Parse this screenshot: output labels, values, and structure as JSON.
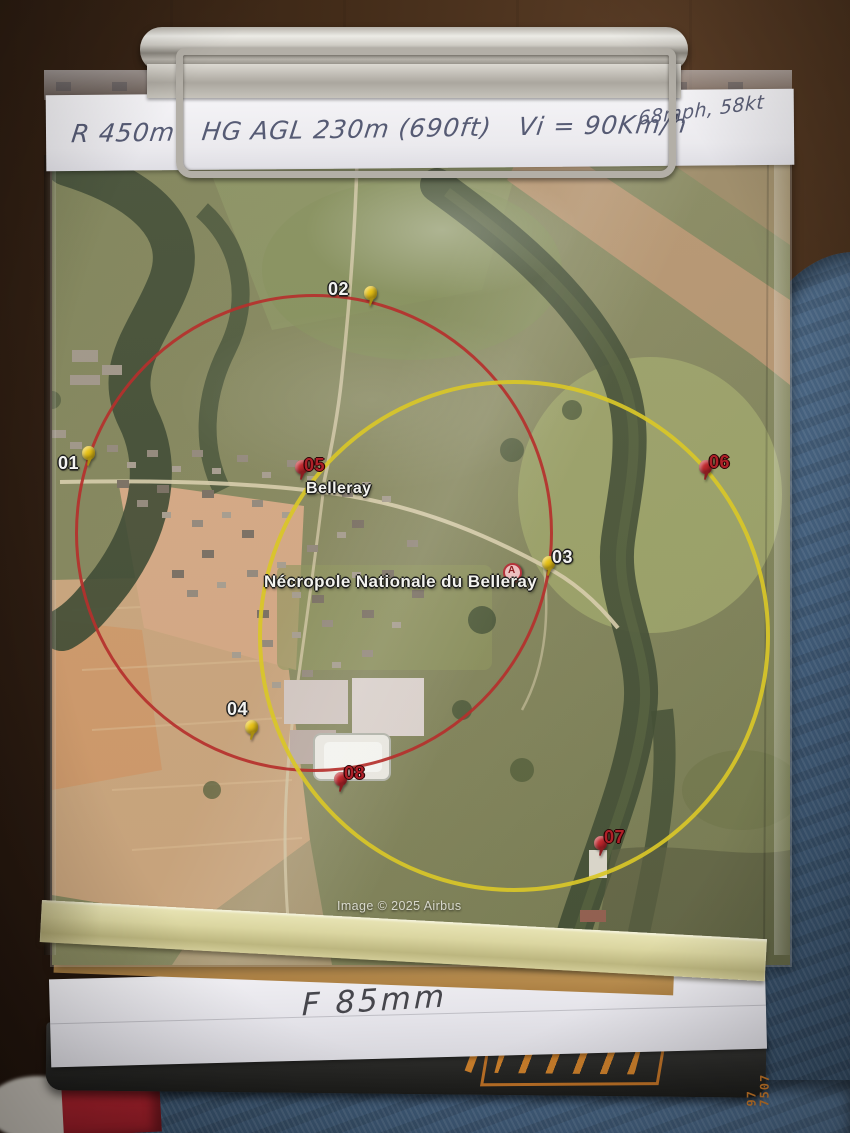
{
  "photo": {
    "handwriting": {
      "top_line": "R 450m   HG AGL 230m (690ft)   Vi = 90Km/h",
      "top_line_right": "68mph, 58kt",
      "focal_length": "F 85mm"
    },
    "map": {
      "attribution": "Image © 2025 Airbus",
      "place_labels": [
        {
          "text": "Belleray",
          "x": 306,
          "y": 480,
          "size": 16
        },
        {
          "text": "Nécropole Nationale du Belleray",
          "x": 264,
          "y": 572,
          "size": 17
        }
      ],
      "poi_marker": {
        "letter": "A",
        "x": 503,
        "y": 563,
        "color": "#b5343c"
      },
      "circles": [
        {
          "name": "red-range-ring",
          "color": "#b5302c",
          "cx": 311,
          "cy": 530,
          "r": 236,
          "border": 3
        },
        {
          "name": "yellow-range-ring",
          "color": "#d9c728",
          "cx": 510,
          "cy": 632,
          "r": 252,
          "border": 4
        }
      ],
      "pins": [
        {
          "id": "01",
          "color": "#e8c216",
          "x": 82,
          "y": 446,
          "label": "01",
          "label_x": 58,
          "label_y": 454,
          "label_style": "white"
        },
        {
          "id": "02",
          "color": "#e8c216",
          "x": 364,
          "y": 286,
          "label": "02",
          "label_x": 328,
          "label_y": 280,
          "label_style": "white"
        },
        {
          "id": "03",
          "color": "#e8c216",
          "x": 542,
          "y": 556,
          "label": "03",
          "label_x": 552,
          "label_y": 548,
          "label_style": "white"
        },
        {
          "id": "04",
          "color": "#e8c216",
          "x": 245,
          "y": 720,
          "label": "04",
          "label_x": 227,
          "label_y": 700,
          "label_style": "white"
        },
        {
          "id": "05",
          "color": "#c0272d",
          "x": 295,
          "y": 460,
          "label": "05",
          "label_x": 304,
          "label_y": 456,
          "label_style": "red"
        },
        {
          "id": "06",
          "color": "#c0272d",
          "x": 699,
          "y": 460,
          "label": "06",
          "label_x": 709,
          "label_y": 453,
          "label_style": "red"
        },
        {
          "id": "07",
          "color": "#c0272d",
          "x": 594,
          "y": 836,
          "label": "07",
          "label_x": 604,
          "label_y": 828,
          "label_style": "red"
        },
        {
          "id": "08",
          "color": "#c0272d",
          "x": 334,
          "y": 772,
          "label": "08",
          "label_x": 344,
          "label_y": 764,
          "label_style": "red"
        }
      ]
    },
    "kneeboard_case": {
      "side_number_top": "97",
      "side_number_bottom": "7507"
    }
  }
}
